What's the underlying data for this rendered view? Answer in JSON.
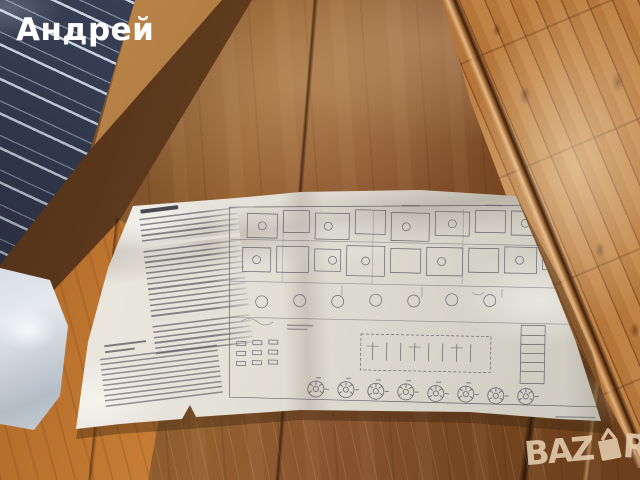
{
  "watermark": {
    "text": "Андрей",
    "color": "#ffffff"
  },
  "logo": {
    "full_text": "BAZAR",
    "text_before_bag_icon": "BAZ",
    "text_after_bag_icon": "R",
    "icon": "shopping-bag-icon",
    "color": "#e0c7a7"
  },
  "scene": {
    "colors": {
      "table_wood": "#8a5530",
      "table_edge_plank": "#c67d33",
      "floor_wood": "#b97c40",
      "bed_fabric": "#353d52",
      "fabric_stripe": "#c7d2de",
      "plastic_bag": "#dbe1e7",
      "paper": "#e3e0d7",
      "schematic_ink": "#4c4c58"
    }
  }
}
